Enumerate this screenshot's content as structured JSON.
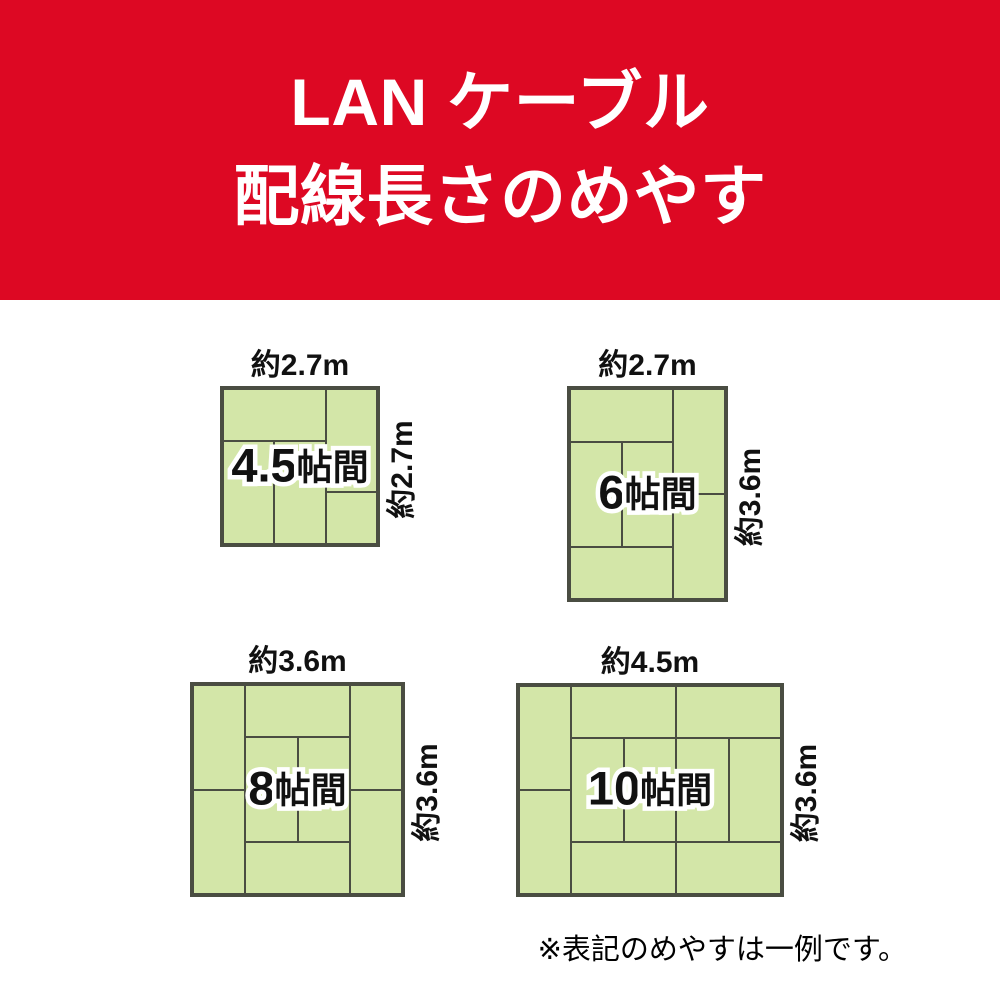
{
  "banner": {
    "title_line1": "LAN ケーブル",
    "title_line2": "配線長さのめやす"
  },
  "colors": {
    "banner_red": "#dd0823",
    "mat_fill": "#d3e6a8",
    "mat_border": "#4a4d42",
    "label_text": "#111111"
  },
  "rooms": [
    {
      "name": "room-4-5jo",
      "label_number": "4.5",
      "label_suffix": "帖間",
      "width_label": "約2.7m",
      "height_label": "約2.7m",
      "box": {
        "left": 220,
        "top": 386,
        "width": 160,
        "height": 161
      },
      "mats": [
        [
          0,
          0,
          66.67,
          33.33
        ],
        [
          66.67,
          0,
          33.33,
          66.67
        ],
        [
          0,
          33.33,
          33.33,
          66.67
        ],
        [
          33.33,
          33.33,
          33.34,
          66.67
        ],
        [
          66.67,
          66.67,
          33.33,
          33.33
        ]
      ]
    },
    {
      "name": "room-6jo",
      "label_number": "6",
      "label_suffix": "帖間",
      "width_label": "約2.7m",
      "height_label": "約3.6m",
      "box": {
        "left": 567,
        "top": 386,
        "width": 161,
        "height": 216
      },
      "mats": [
        [
          0,
          0,
          66.67,
          25
        ],
        [
          66.67,
          0,
          33.33,
          50
        ],
        [
          0,
          25,
          33.33,
          50
        ],
        [
          33.33,
          25,
          33.34,
          50
        ],
        [
          66.67,
          50,
          33.33,
          50
        ],
        [
          0,
          75,
          66.67,
          25
        ]
      ]
    },
    {
      "name": "room-8jo",
      "label_number": "8",
      "label_suffix": "帖間",
      "width_label": "約3.6m",
      "height_label": "約3.6m",
      "box": {
        "left": 190,
        "top": 682,
        "width": 215,
        "height": 215
      },
      "mats": [
        [
          0,
          0,
          25,
          50
        ],
        [
          25,
          0,
          50,
          25
        ],
        [
          75,
          0,
          25,
          50
        ],
        [
          25,
          25,
          25,
          50
        ],
        [
          50,
          25,
          25,
          50
        ],
        [
          0,
          50,
          25,
          50
        ],
        [
          75,
          50,
          25,
          50
        ],
        [
          25,
          75,
          50,
          25
        ]
      ]
    },
    {
      "name": "room-10jo",
      "label_number": "10",
      "label_suffix": "帖間",
      "width_label": "約4.5m",
      "height_label": "約3.6m",
      "box": {
        "left": 516,
        "top": 683,
        "width": 268,
        "height": 214
      },
      "mats": [
        [
          0,
          0,
          20,
          50
        ],
        [
          20,
          0,
          40,
          25
        ],
        [
          60,
          0,
          40,
          25
        ],
        [
          0,
          50,
          20,
          50
        ],
        [
          20,
          25,
          20,
          50
        ],
        [
          40,
          25,
          20,
          50
        ],
        [
          60,
          25,
          20,
          50
        ],
        [
          80,
          25,
          20,
          50
        ],
        [
          20,
          75,
          40,
          25
        ],
        [
          60,
          75,
          40,
          25
        ]
      ]
    }
  ],
  "note": "※表記のめやすは一例です。"
}
